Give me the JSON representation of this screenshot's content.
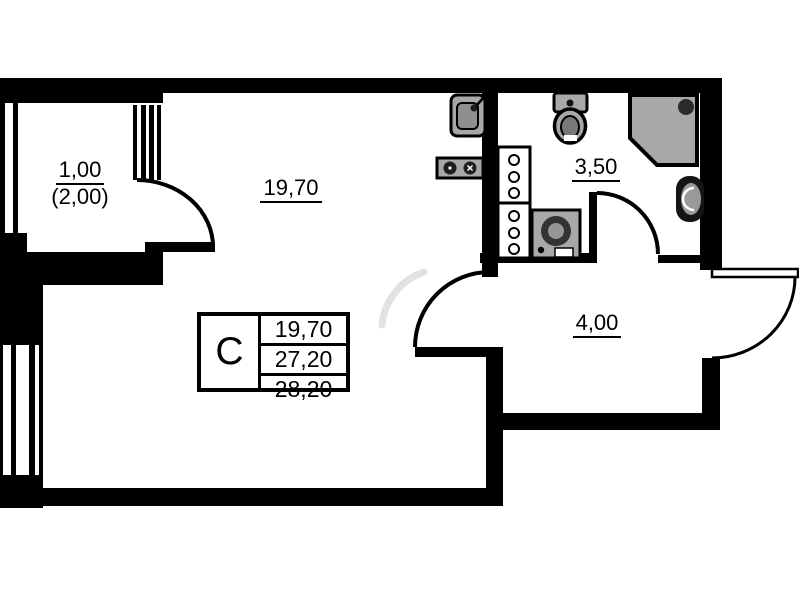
{
  "title": "Studio apartment floor plan",
  "rooms": {
    "balcony": {
      "area": "1,00",
      "area_alt": "(2,00)"
    },
    "living_room": {
      "area": "19,70"
    },
    "bathroom": {
      "area": "3,50"
    },
    "hallway": {
      "area": "4,00"
    }
  },
  "info_table": {
    "type_label": "C",
    "rows": [
      "19,70",
      "27,20",
      "28,20"
    ]
  },
  "colors": {
    "wall": "#000000",
    "fixture_fill": "#a8a8a8",
    "background": "#ffffff"
  },
  "symbols": [
    "window",
    "door-arc",
    "toilet-symbol",
    "shower-symbol",
    "washbasin-symbol",
    "washing-machine-symbol",
    "kitchen-sink-symbol",
    "stove-symbol",
    "vent-shaft-symbol"
  ]
}
